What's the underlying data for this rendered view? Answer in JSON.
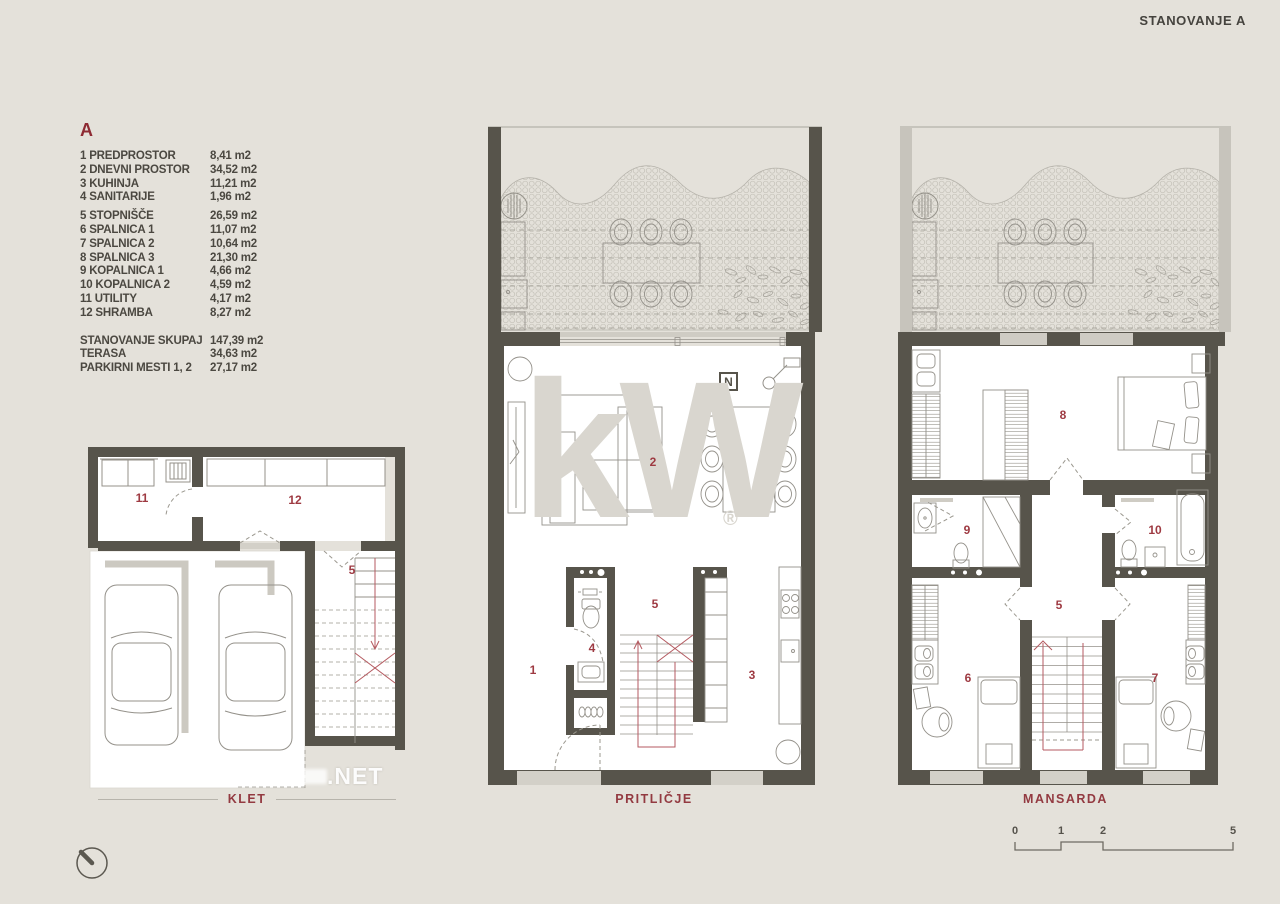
{
  "title": "STANOVANJE A",
  "legend": {
    "header": "A",
    "rooms": [
      {
        "label": "1 PREDPROSTOR",
        "area": "8,41 m2"
      },
      {
        "label": "2 DNEVNI PROSTOR",
        "area": "34,52 m2"
      },
      {
        "label": "3 KUHINJA",
        "area": "11,21 m2"
      },
      {
        "label": "4 SANITARIJE",
        "area": "1,96 m2"
      },
      {
        "label": "5 STOPNIŠČE",
        "area": "26,59 m2"
      },
      {
        "label": "6 SPALNICA 1",
        "area": "11,07 m2"
      },
      {
        "label": "7 SPALNICA 2",
        "area": "10,64 m2"
      },
      {
        "label": "8 SPALNICA 3",
        "area": "21,30 m2"
      },
      {
        "label": "9 KOPALNICA 1",
        "area": "4,66 m2"
      },
      {
        "label": "10 KOPALNICA 2",
        "area": "4,59 m2"
      },
      {
        "label": "11 UTILITY",
        "area": "4,17 m2"
      },
      {
        "label": "12 SHRAMBA",
        "area": "8,27 m2"
      }
    ],
    "totals": [
      {
        "label": "STANOVANJE SKUPAJ",
        "area": "147,39 m2"
      },
      {
        "label": "TERASA",
        "area": "34,63 m2"
      },
      {
        "label": "PARKIRNI MESTI 1, 2",
        "area": "27,17 m2"
      }
    ]
  },
  "floors": {
    "klet": {
      "label": "KLET",
      "room_numbers": {
        "r11": "11",
        "r12": "12",
        "r5": "5"
      }
    },
    "pritlicje": {
      "label": "PRITLIČJE",
      "north_logo": "N",
      "room_numbers": {
        "r1": "1",
        "r2": "2",
        "r3": "3",
        "r4": "4",
        "r5": "5"
      }
    },
    "mansarda": {
      "label": "MANSARDA",
      "room_numbers": {
        "r5": "5",
        "r6": "6",
        "r7": "7",
        "r8": "8",
        "r9": "9",
        "r10": "10"
      }
    }
  },
  "watermarks": {
    "kw": "kW",
    "registered": "®",
    "site": ".NET"
  },
  "scale_bar": {
    "ticks": [
      "0",
      "1",
      "2",
      "5"
    ]
  },
  "colors": {
    "background": "#e4e1da",
    "wall": "#57544b",
    "accent_red": "#933a41",
    "room_number_red": "#9e3a42",
    "stair_red": "#b45a60",
    "furniture_line": "#94918a",
    "light_gray": "#d3d0c8",
    "legend_text": "#4b4841",
    "watermark_gray": "#d9d6cf"
  }
}
